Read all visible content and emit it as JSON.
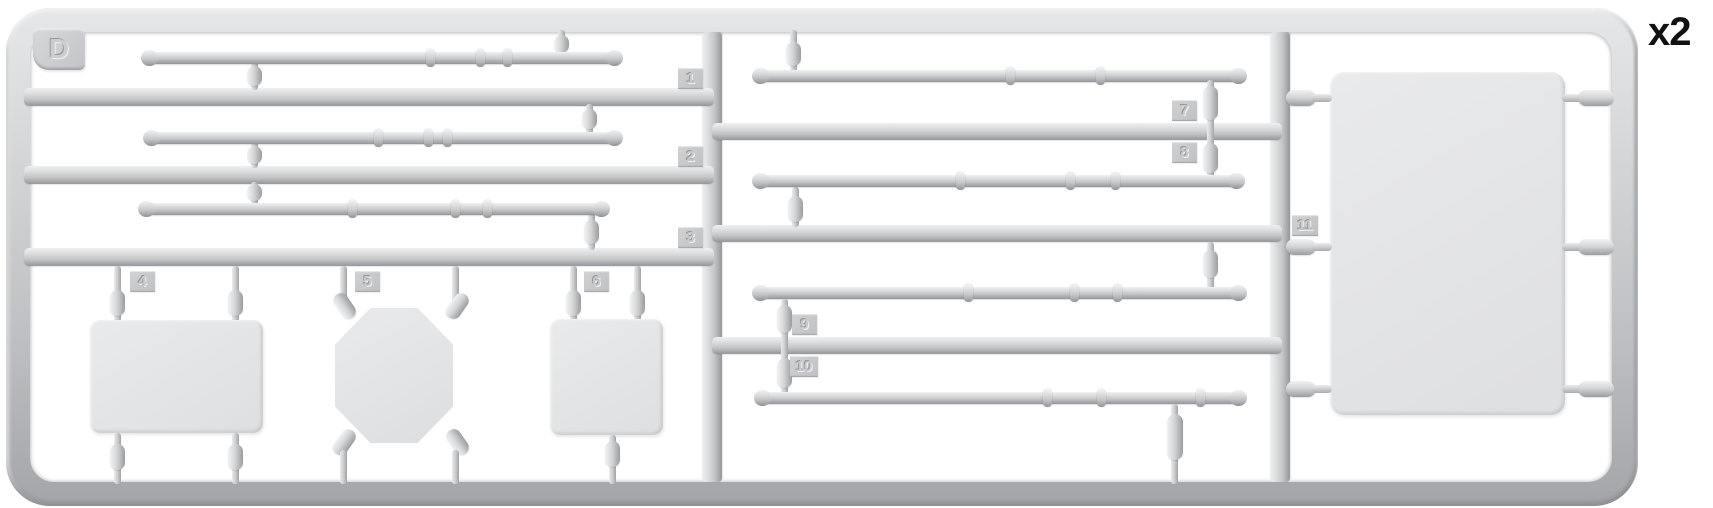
{
  "figure": {
    "sprue_letter": "D",
    "quantity_label": "x2",
    "part_numbers": [
      "1",
      "2",
      "3",
      "4",
      "5",
      "6",
      "7",
      "8",
      "9",
      "10",
      "11"
    ]
  },
  "colors": {
    "background": "#ffffff",
    "plastic_base": "#cfd1d3",
    "plastic_highlight": "#f0f1f2",
    "plastic_shadow": "#95979a",
    "panel_fill": "#e5e6e8",
    "quantity_text": "#111111"
  }
}
